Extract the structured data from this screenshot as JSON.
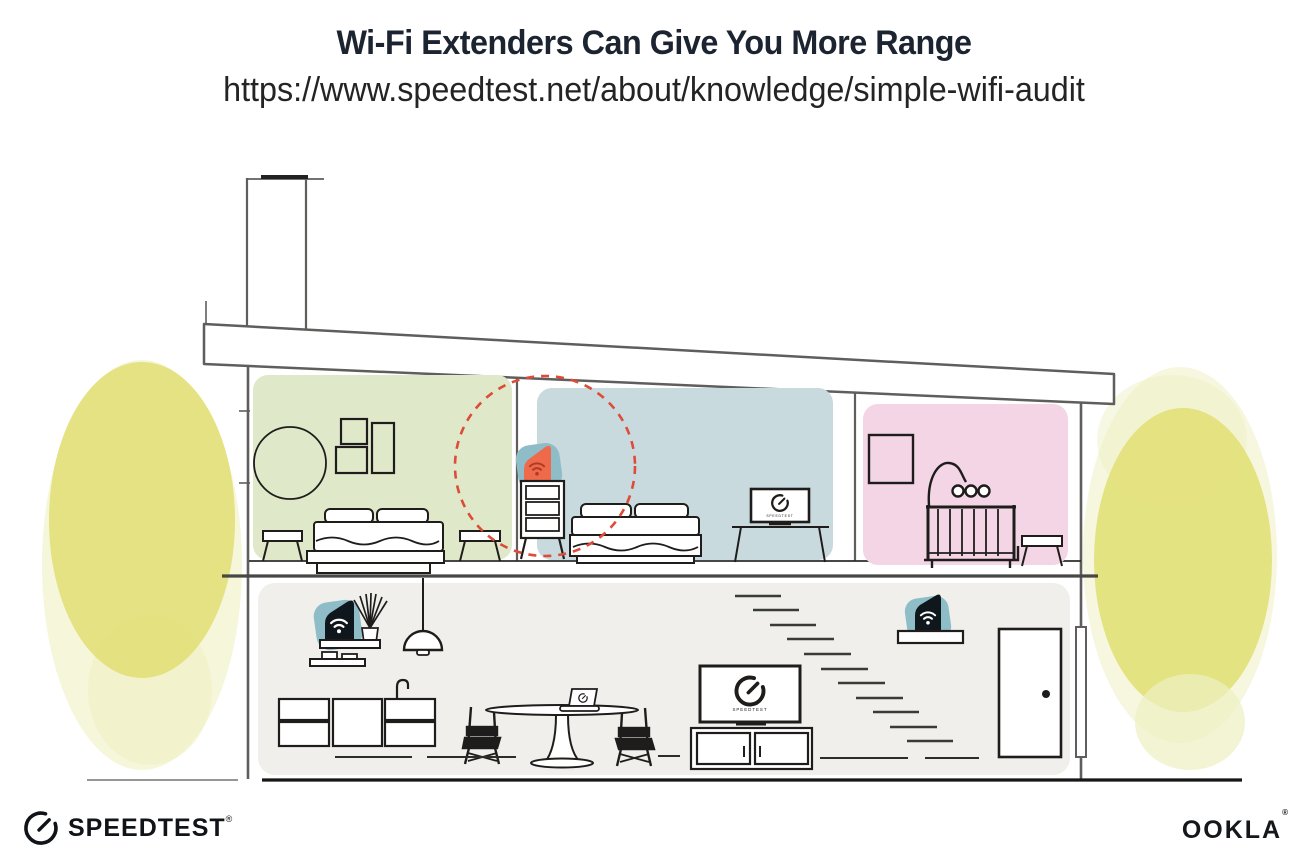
{
  "header": {
    "title": "Wi-Fi Extenders Can Give You More Range",
    "url": "https://www.speedtest.net/about/knowledge/simple-wifi-audit"
  },
  "screens": {
    "tv_bedroom": "SPEEDTEST",
    "tv_living": "SPEEDTEST"
  },
  "footer": {
    "speedtest_wordmark": "SPEEDTEST",
    "speedtest_reg": "®",
    "ookla_wordmark": "OOKLA",
    "ookla_reg": "®"
  },
  "colors": {
    "title_text": "#1b2430",
    "url_text": "#242424",
    "green_room": "#dfe9ca",
    "blue_room": "#c8dadd",
    "pink_room": "#f3d5e5",
    "gray_floor": "#f0efec",
    "teal_accent": "#8fbdc7",
    "orange_accent": "#ee6a4b",
    "orange_wifi": "#b03a26",
    "red_range": "#dd4c38",
    "yellow_bush": "#e2e078",
    "yellow_bush_light": "#eef0c2",
    "structure_line": "#5f5e5c",
    "furniture_line": "#1f1d1b",
    "device_black": "#10171c"
  }
}
